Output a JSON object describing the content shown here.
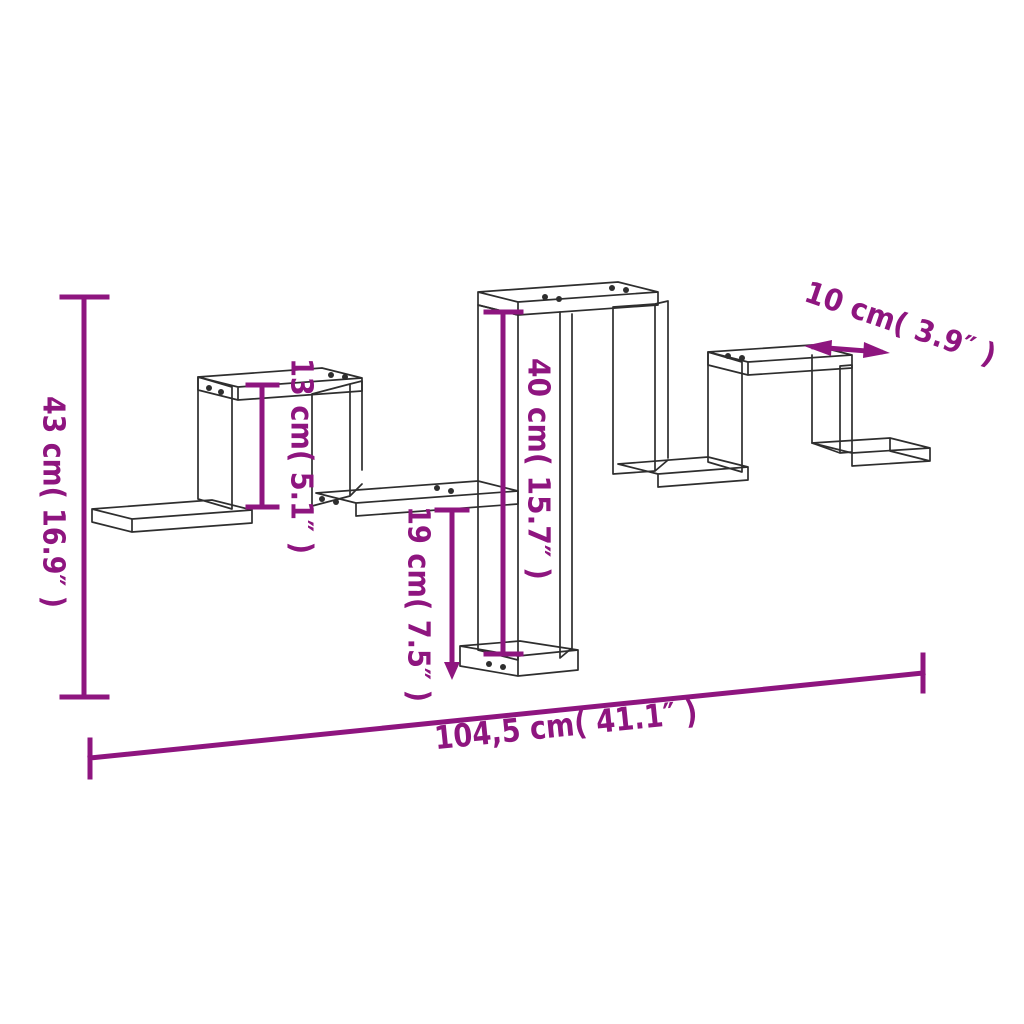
{
  "page": {
    "title": "Wall shelf dimension diagram",
    "background": "#ffffff"
  },
  "drawing": {
    "subject": "zigzag wall cube shelf line drawing",
    "line_color": "#2e2e2e"
  },
  "dimensions": {
    "color": "#8E157F",
    "total_height": {
      "label": "43 cm( 16.9″ )",
      "cm": "43",
      "inch": "16.9"
    },
    "cube_inner_height": {
      "label": "13 cm( 5.1″ )",
      "cm": "13",
      "inch": "5.1"
    },
    "middle_section_height": {
      "label": "40 cm( 15.7″ )",
      "cm": "40",
      "inch": "15.7"
    },
    "lower_section_height": {
      "label": "19 cm( 7.5″ )",
      "cm": "19",
      "inch": "7.5"
    },
    "shelf_depth": {
      "label": "10 cm( 3.9″ )",
      "cm": "10",
      "inch": "3.9"
    },
    "total_width": {
      "label": "104,5 cm( 41.1″ )",
      "cm": "104,5",
      "inch": "41.1"
    }
  }
}
